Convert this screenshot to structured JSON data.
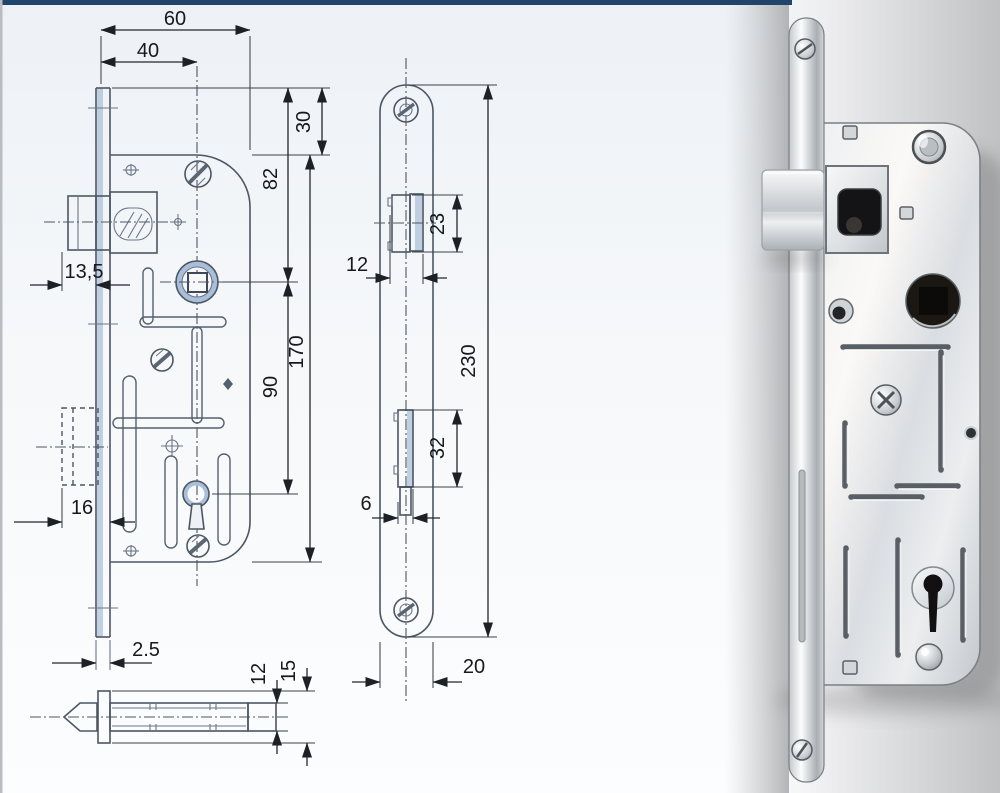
{
  "header": {
    "bar_color": "#20456b"
  },
  "drawing": {
    "front_view": {
      "dims": {
        "overall_depth": "60",
        "backset": "40",
        "plate_overhang_top": "30",
        "plate_top_to_follower": "82",
        "latch_protrusion": "13,5",
        "follower_to_keyhole": "90",
        "case_height": "170",
        "deadbolt_protrusion": "16",
        "faceplate_thickness": "2.5"
      }
    },
    "latch_detail_view": {
      "dims": {
        "latch_body_height": "12",
        "latch_flange_height": "15"
      }
    },
    "side_view": {
      "dims": {
        "latch_face_height": "23",
        "latch_face_depth": "12",
        "faceplate_length": "230",
        "deadbolt_face_height": "32",
        "deadbolt_face_depth": "6",
        "faceplate_width": "20"
      }
    }
  },
  "photo": {
    "colors": {
      "background_light": "#ffffff",
      "background_shade": "#bfc1c3",
      "metal_light": "#f4f5f6",
      "metal_mid": "#c9ccd0",
      "metal_dark": "#8d9297",
      "hole_dark": "#1a1713"
    }
  }
}
